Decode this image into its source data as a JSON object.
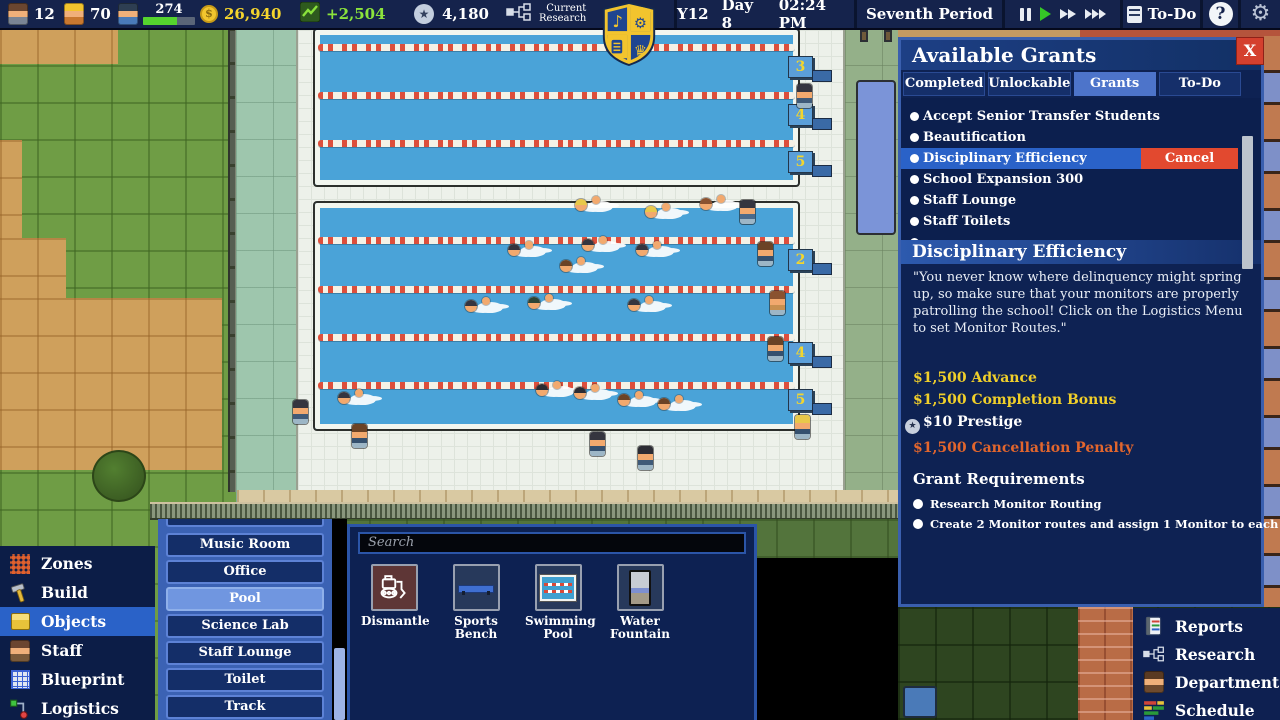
{
  "topbar": {
    "teachers": "12",
    "builders": "70",
    "students": "274",
    "money": "26,940",
    "money_delta": "+2,504",
    "prestige": "4,180",
    "research_line1": "Current",
    "research_line2": "Research",
    "year": "Y12",
    "day": "Day 8",
    "time": "02:24 PM",
    "period": "Seventh Period",
    "todo": "To-Do",
    "help": "?"
  },
  "grants": {
    "title": "Available Grants",
    "close": "X",
    "tabs": [
      "Completed",
      "Unlockable",
      "Grants",
      "To-Do"
    ],
    "active_tab": "Grants",
    "items": [
      "Accept Senior Transfer Students",
      "Beautification",
      "Disciplinary Efficiency",
      "School Expansion 300",
      "Staff Lounge",
      "Staff Toilets"
    ],
    "selected_item": "Disciplinary Efficiency",
    "cancel": "Cancel",
    "detail_title": "Disciplinary Efficiency",
    "description": "\"You never know where delinquency might spring up, so make sure that your monitors are properly patrolling the school! Click on the Logistics Menu to set Monitor Routes.\"",
    "rewards": {
      "advance": "$1,500 Advance",
      "completion": "$1,500 Completion Bonus",
      "prestige": "$10 Prestige",
      "penalty": "$1,500 Cancellation Penalty"
    },
    "requirements_title": "Grant Requirements",
    "requirements": [
      "Research Monitor Routing",
      "Create 2 Monitor routes and assign 1 Monitor to each route"
    ]
  },
  "build_menu": {
    "items": [
      "Zones",
      "Build",
      "Objects",
      "Staff",
      "Blueprint",
      "Logistics"
    ],
    "selected": "Objects"
  },
  "room_menu": {
    "items": [
      "Music Room",
      "Office",
      "Pool",
      "Science Lab",
      "Staff Lounge",
      "Toilet",
      "Track"
    ],
    "selected": "Pool"
  },
  "objects_panel": {
    "search_placeholder": "Search",
    "items": [
      "Dismantle",
      "Sports Bench",
      "Swimming Pool",
      "Water Fountain"
    ]
  },
  "system_menu": {
    "items": [
      "Reports",
      "Research",
      "Department",
      "Schedule"
    ]
  },
  "world": {
    "top_pool_lanes": [
      "3",
      "4",
      "5"
    ],
    "mid_pool_lanes": [
      "2",
      "4",
      "5"
    ]
  },
  "colors": {
    "accent_blue": "#2a62c8",
    "money_yellow": "#f4d42d",
    "income_green": "#8be33c",
    "reward_yellow": "#f0cf2a",
    "penalty_orange": "#e2662d",
    "cancel_red": "#e2492f",
    "close_red": "#d4402e",
    "water_blue": "#4aa3d8",
    "panel_navy": "#0e2253"
  }
}
